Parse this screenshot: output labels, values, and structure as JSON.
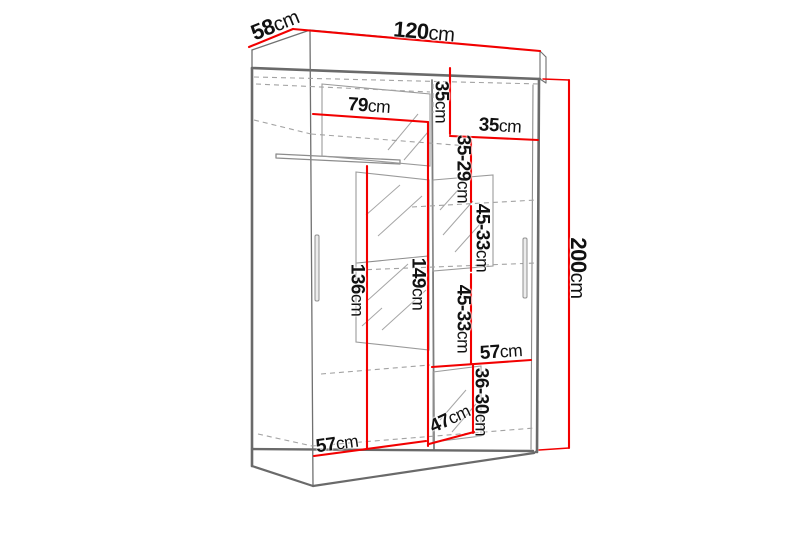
{
  "diagram": {
    "title": "wardrobe-dimension-diagram",
    "colors": {
      "background": "#ffffff",
      "dimension_red": "#f20000",
      "structure_gray": "#707070",
      "hidden_line_gray": "#a3a3a3",
      "text_black": "#111111"
    },
    "dimensions": [
      {
        "id": "top-depth",
        "num": "58",
        "unit": "cm"
      },
      {
        "id": "top-width",
        "num": "120",
        "unit": "cm"
      },
      {
        "id": "left-section-width",
        "num": "79",
        "unit": "cm"
      },
      {
        "id": "top-right-height",
        "num": "35",
        "unit": "cm"
      },
      {
        "id": "right-section-width",
        "num": "35",
        "unit": "cm"
      },
      {
        "id": "shelf-gap-1",
        "num": "35-29",
        "unit": "cm"
      },
      {
        "id": "shelf-gap-2",
        "num": "45-33",
        "unit": "cm"
      },
      {
        "id": "shelf-gap-3",
        "num": "45-33",
        "unit": "cm"
      },
      {
        "id": "shelf-width-right",
        "num": "57",
        "unit": "cm"
      },
      {
        "id": "shelf-gap-4",
        "num": "36-30",
        "unit": "cm"
      },
      {
        "id": "interior-depth",
        "num": "47",
        "unit": "cm"
      },
      {
        "id": "floor-width-left",
        "num": "57",
        "unit": "cm"
      },
      {
        "id": "left-interior-height",
        "num": "136",
        "unit": "cm"
      },
      {
        "id": "mid-interior-height",
        "num": "149",
        "unit": "cm"
      },
      {
        "id": "total-height",
        "num": "200",
        "unit": "cm"
      }
    ]
  }
}
